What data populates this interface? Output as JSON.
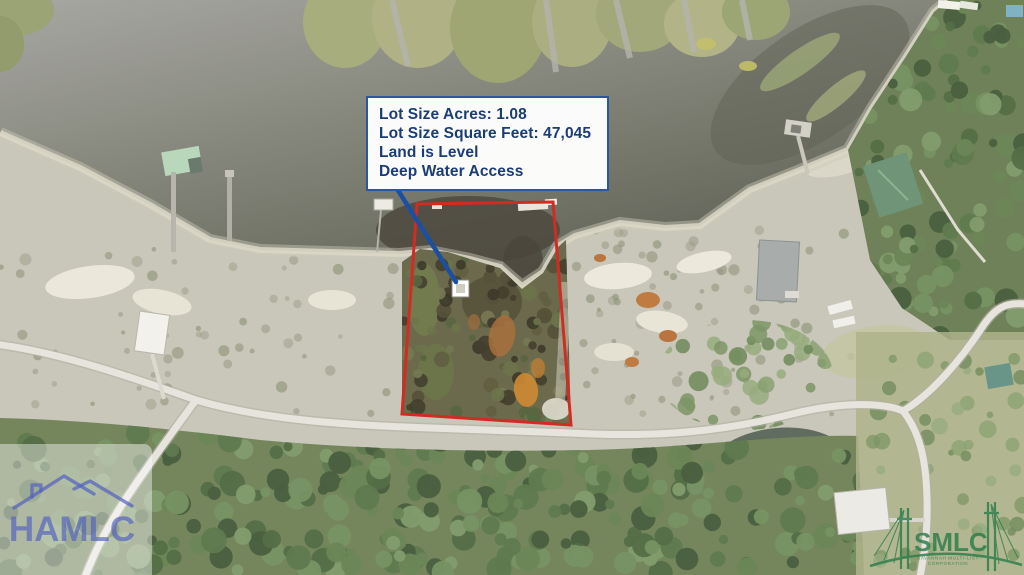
{
  "info_box": {
    "lot_size_acres": "Lot Size Acres: 1.08",
    "lot_size_sqft": "Lot Size Square Feet: 47,045",
    "land_level": "Land is Level",
    "water_access": "Deep Water Access"
  },
  "watermarks": {
    "hamlc": {
      "text": "HAMLC"
    },
    "smlc": {
      "text": "SMLC",
      "tagline_line1": "SAVANNAH MULTI-LIST",
      "tagline_line2": "CORPORATION"
    }
  },
  "colors": {
    "boundary-red": "#d32b23",
    "arrow-blue": "#1d4fa1",
    "info-text-blue": "#1b3d75",
    "info-border-blue": "#2a57a5",
    "hamlc-blue": "#5462c0",
    "smlc-green": "#2b7d4b"
  }
}
